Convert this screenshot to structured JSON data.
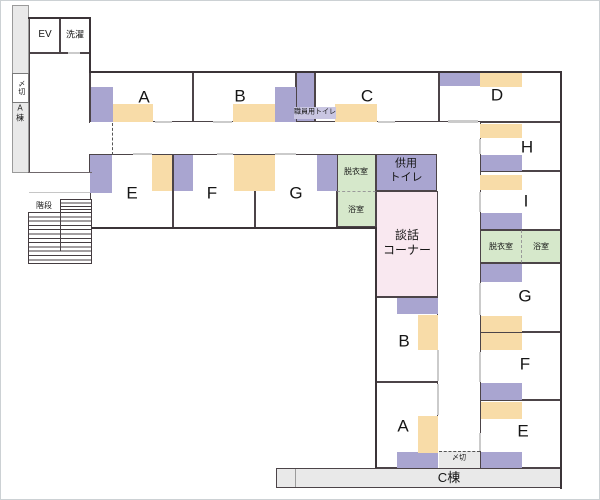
{
  "colors": {
    "white": "#ffffff",
    "gray": "#e9e9e9",
    "purple": "#a9a5d0",
    "orange": "#f8dca8",
    "green": "#d6e8cb",
    "pink": "#f9e8f0",
    "lightPurple": "#c9c6e2",
    "wall": "#3b3438"
  },
  "floorplan": {
    "areas": [
      {
        "n": "a-wing-strip",
        "x": 12,
        "y": 5,
        "w": 17,
        "h": 168,
        "f": "gray",
        "c": "thin"
      },
      {
        "n": "shimekiri-left-box",
        "x": 12,
        "y": 73,
        "w": 17,
        "h": 30,
        "f": "white",
        "c": "thin2"
      },
      {
        "n": "hall",
        "x": 29,
        "y": 53,
        "w": 61,
        "h": 120
      },
      {
        "n": "ev-room",
        "x": 29,
        "y": 18,
        "w": 31,
        "h": 35
      },
      {
        "n": "laundry-room",
        "x": 60,
        "y": 18,
        "w": 30,
        "h": 35
      },
      {
        "n": "room-a",
        "x": 90,
        "y": 72,
        "w": 103,
        "h": 50
      },
      {
        "n": "room-b",
        "x": 193,
        "y": 72,
        "w": 103,
        "h": 50
      },
      {
        "n": "staff-toilet-room",
        "x": 296,
        "y": 72,
        "w": 19,
        "h": 50,
        "f": "purple"
      },
      {
        "n": "room-c",
        "x": 315,
        "y": 72,
        "w": 124,
        "h": 50
      },
      {
        "n": "room-d",
        "x": 439,
        "y": 72,
        "w": 123,
        "h": 50
      },
      {
        "n": "room-e",
        "x": 90,
        "y": 154,
        "w": 83,
        "h": 74
      },
      {
        "n": "room-f",
        "x": 173,
        "y": 154,
        "w": 82,
        "h": 74
      },
      {
        "n": "room-g",
        "x": 255,
        "y": 154,
        "w": 82,
        "h": 74
      },
      {
        "n": "dressing-room-top",
        "x": 337,
        "y": 154,
        "w": 39,
        "h": 38,
        "f": "green",
        "c": "dash-b"
      },
      {
        "n": "bath-room-top",
        "x": 337,
        "y": 192,
        "w": 39,
        "h": 35,
        "f": "green",
        "c": "no-t"
      },
      {
        "n": "shared-toilet-room",
        "x": 376,
        "y": 154,
        "w": 61,
        "h": 37,
        "f": "purple"
      },
      {
        "n": "lounge-corner",
        "x": 376,
        "y": 191,
        "w": 62,
        "h": 106,
        "f": "pink"
      },
      {
        "n": "room-b-central",
        "x": 376,
        "y": 297,
        "w": 62,
        "h": 85
      },
      {
        "n": "room-a-central",
        "x": 376,
        "y": 382,
        "w": 62,
        "h": 86
      },
      {
        "n": "room-h",
        "x": 480,
        "y": 122,
        "w": 82,
        "h": 49
      },
      {
        "n": "room-i",
        "x": 480,
        "y": 171,
        "w": 82,
        "h": 59
      },
      {
        "n": "dressing-room-right",
        "x": 480,
        "y": 230,
        "w": 42,
        "h": 33,
        "f": "green",
        "c": "dash-r"
      },
      {
        "n": "bath-room-right",
        "x": 522,
        "y": 230,
        "w": 40,
        "h": 33,
        "f": "green",
        "c": "no-l"
      },
      {
        "n": "room-g-right",
        "x": 480,
        "y": 263,
        "w": 82,
        "h": 69
      },
      {
        "n": "room-f-right",
        "x": 480,
        "y": 332,
        "w": 82,
        "h": 68
      },
      {
        "n": "room-e-right",
        "x": 480,
        "y": 400,
        "w": 82,
        "h": 68
      },
      {
        "n": "c-wing-corridor",
        "x": 276,
        "y": 468,
        "w": 286,
        "h": 20,
        "f": "gray"
      },
      {
        "n": "shimekiri-bottom-box",
        "x": 439,
        "y": 451,
        "w": 41,
        "h": 17,
        "f": "gray",
        "c": "dash-t-only"
      },
      {
        "n": "stairs-upper-flight",
        "x": 60,
        "y": 199,
        "w": 32,
        "h": 14,
        "c": "steps-u"
      },
      {
        "n": "stairs-main-flight",
        "x": 28,
        "y": 212,
        "w": 64,
        "h": 52,
        "c": "steps-m"
      }
    ],
    "furniture": [
      {
        "n": "furniture-a-purple",
        "x": 91,
        "y": 87,
        "w": 22,
        "h": 35,
        "f": "purple"
      },
      {
        "n": "furniture-b-purple",
        "x": 275,
        "y": 87,
        "w": 21,
        "h": 35,
        "f": "purple"
      },
      {
        "n": "furniture-d-purple",
        "x": 440,
        "y": 73,
        "w": 40,
        "h": 13,
        "f": "purple"
      },
      {
        "n": "furniture-e-purple",
        "x": 90,
        "y": 155,
        "w": 22,
        "h": 38,
        "f": "purple"
      },
      {
        "n": "furniture-f-purple",
        "x": 174,
        "y": 155,
        "w": 19,
        "h": 36,
        "f": "purple"
      },
      {
        "n": "furniture-g-purple",
        "x": 317,
        "y": 155,
        "w": 20,
        "h": 36,
        "f": "purple"
      },
      {
        "n": "furniture-b-central-purple",
        "x": 397,
        "y": 298,
        "w": 41,
        "h": 16,
        "f": "purple"
      },
      {
        "n": "furniture-a-central-purple",
        "x": 397,
        "y": 452,
        "w": 41,
        "h": 16,
        "f": "purple"
      },
      {
        "n": "furniture-h-purple",
        "x": 481,
        "y": 155,
        "w": 41,
        "h": 16,
        "f": "purple"
      },
      {
        "n": "furniture-i-purple",
        "x": 481,
        "y": 213,
        "w": 41,
        "h": 16,
        "f": "purple"
      },
      {
        "n": "furniture-g-right-purple",
        "x": 481,
        "y": 264,
        "w": 41,
        "h": 18,
        "f": "purple"
      },
      {
        "n": "furniture-f-right-purple",
        "x": 481,
        "y": 383,
        "w": 41,
        "h": 17,
        "f": "purple"
      },
      {
        "n": "furniture-e-right-purple",
        "x": 481,
        "y": 452,
        "w": 41,
        "h": 16,
        "f": "purple"
      },
      {
        "n": "furniture-a-orange",
        "x": 113,
        "y": 104,
        "w": 40,
        "h": 18,
        "f": "orange"
      },
      {
        "n": "furniture-b-orange",
        "x": 233,
        "y": 104,
        "w": 42,
        "h": 18,
        "f": "orange"
      },
      {
        "n": "furniture-c-orange",
        "x": 335,
        "y": 104,
        "w": 42,
        "h": 18,
        "f": "orange"
      },
      {
        "n": "furniture-d-orange",
        "x": 480,
        "y": 72,
        "w": 42,
        "h": 15,
        "f": "orange"
      },
      {
        "n": "furniture-e-orange",
        "x": 152,
        "y": 155,
        "w": 20,
        "h": 36,
        "f": "orange"
      },
      {
        "n": "furniture-f-orange",
        "x": 234,
        "y": 155,
        "w": 21,
        "h": 36,
        "f": "orange"
      },
      {
        "n": "furniture-g-orange",
        "x": 255,
        "y": 155,
        "w": 20,
        "h": 36,
        "f": "orange"
      },
      {
        "n": "furniture-b-central-orange",
        "x": 418,
        "y": 315,
        "w": 20,
        "h": 35,
        "f": "orange"
      },
      {
        "n": "furniture-a-central-orange",
        "x": 418,
        "y": 416,
        "w": 20,
        "h": 37,
        "f": "orange"
      },
      {
        "n": "furniture-h-orange",
        "x": 480,
        "y": 124,
        "w": 42,
        "h": 14,
        "f": "orange"
      },
      {
        "n": "furniture-i-orange",
        "x": 480,
        "y": 175,
        "w": 42,
        "h": 15,
        "f": "orange"
      },
      {
        "n": "furniture-g-right-orange",
        "x": 481,
        "y": 316,
        "w": 41,
        "h": 16,
        "f": "orange"
      },
      {
        "n": "furniture-f-right-orange",
        "x": 481,
        "y": 333,
        "w": 41,
        "h": 17,
        "f": "orange"
      },
      {
        "n": "furniture-e-right-orange",
        "x": 481,
        "y": 402,
        "w": 41,
        "h": 17,
        "f": "orange"
      },
      {
        "n": "staff-toilet-label-bg",
        "x": 294,
        "y": 107,
        "w": 42,
        "h": 12,
        "f": "lightPurple"
      }
    ],
    "walls": [
      {
        "n": "wall-ev-top",
        "x": 28,
        "y": 17,
        "w": 63,
        "h": 2
      },
      {
        "n": "wall-ev-right",
        "x": 89,
        "y": 17,
        "w": 2,
        "h": 56
      },
      {
        "n": "wall-top",
        "x": 90,
        "y": 71,
        "w": 472,
        "h": 2
      },
      {
        "n": "wall-right",
        "x": 560,
        "y": 71,
        "w": 2,
        "h": 418
      },
      {
        "n": "wall-row2-bottom",
        "x": 91,
        "y": 227,
        "w": 286,
        "h": 2
      },
      {
        "n": "wall-central-left",
        "x": 375,
        "y": 227,
        "w": 2,
        "h": 241
      },
      {
        "n": "wall-hall-bottom",
        "x": 28,
        "y": 172,
        "w": 64,
        "h": 1,
        "f": "#6f676b"
      },
      {
        "n": "stairs-divider",
        "x": 60,
        "y": 212,
        "w": 1,
        "h": 39,
        "f": "#4a4246"
      },
      {
        "n": "c-strip-divider",
        "x": 295,
        "y": 469,
        "w": 1,
        "h": 18,
        "f": "#9b9b9b"
      }
    ],
    "gaps": [
      {
        "n": "door-room-a",
        "x": 155,
        "y": 121,
        "w": 17,
        "h": 2
      },
      {
        "n": "door-room-b",
        "x": 213,
        "y": 121,
        "w": 19,
        "h": 2
      },
      {
        "n": "door-room-c",
        "x": 378,
        "y": 121,
        "w": 17,
        "h": 2
      },
      {
        "n": "opening-corridor-d",
        "x": 448,
        "y": 120,
        "w": 30,
        "h": 3
      },
      {
        "n": "door-room-e",
        "x": 133,
        "y": 153,
        "w": 19,
        "h": 2
      },
      {
        "n": "door-room-f",
        "x": 217,
        "y": 153,
        "w": 16,
        "h": 2
      },
      {
        "n": "door-room-g",
        "x": 275,
        "y": 153,
        "w": 21,
        "h": 2
      },
      {
        "n": "door-laundry",
        "x": 68,
        "y": 52,
        "w": 12,
        "h": 2
      },
      {
        "n": "door-room-h",
        "x": 479,
        "y": 139,
        "w": 2,
        "h": 15
      },
      {
        "n": "door-room-i",
        "x": 479,
        "y": 192,
        "w": 2,
        "h": 20
      },
      {
        "n": "door-room-g-right",
        "x": 479,
        "y": 283,
        "w": 2,
        "h": 32
      },
      {
        "n": "door-room-f-right",
        "x": 479,
        "y": 352,
        "w": 2,
        "h": 30
      },
      {
        "n": "door-room-e-right",
        "x": 479,
        "y": 433,
        "w": 2,
        "h": 18
      },
      {
        "n": "door-room-b-central",
        "x": 437,
        "y": 350,
        "w": 2,
        "h": 31
      },
      {
        "n": "door-room-a-central",
        "x": 437,
        "y": 384,
        "w": 2,
        "h": 31
      },
      {
        "n": "opening-hall-corridor",
        "x": 88,
        "y": 123,
        "w": 3,
        "h": 31,
        "f": "#ffffff"
      },
      {
        "n": "stair-landing-line",
        "x": 29,
        "y": 192,
        "w": 61,
        "h": 1,
        "f": "#c6c6c6"
      },
      {
        "n": "corridor-dashed-line",
        "x": 112,
        "y": 123,
        "w": 1,
        "h": 32,
        "c": "dashv"
      }
    ],
    "labels": [
      {
        "n": "label-ev",
        "t": "EV",
        "x": 45,
        "y": 35,
        "s": 10
      },
      {
        "n": "label-laundry",
        "t": "洗濯",
        "x": 75,
        "y": 35,
        "s": 9
      },
      {
        "n": "label-shimekiri-left",
        "t": "〆切",
        "x": 20.5,
        "y": 88,
        "s": 7,
        "c": "vert"
      },
      {
        "n": "label-a-wing",
        "t": "A棟",
        "x": 19.5,
        "y": 113,
        "s": 8,
        "c": "vert"
      },
      {
        "n": "label-room-a",
        "t": "A",
        "x": 144,
        "y": 97,
        "s": 17
      },
      {
        "n": "label-room-b",
        "t": "B",
        "x": 240,
        "y": 96,
        "s": 17
      },
      {
        "n": "label-room-c",
        "t": "C",
        "x": 367,
        "y": 96,
        "s": 17
      },
      {
        "n": "label-room-d",
        "t": "D",
        "x": 497,
        "y": 95,
        "s": 17
      },
      {
        "n": "label-staff-toilet",
        "t": "職員用トイレ",
        "x": 315,
        "y": 113,
        "s": 7
      },
      {
        "n": "label-room-e",
        "t": "E",
        "x": 132,
        "y": 193,
        "s": 17
      },
      {
        "n": "label-room-f",
        "t": "F",
        "x": 212,
        "y": 193,
        "s": 17
      },
      {
        "n": "label-room-g",
        "t": "G",
        "x": 296,
        "y": 193,
        "s": 17
      },
      {
        "n": "label-dressing-top",
        "t": "脱衣室",
        "x": 356,
        "y": 172,
        "s": 8
      },
      {
        "n": "label-bath-top",
        "t": "浴室",
        "x": 356,
        "y": 210,
        "s": 8
      },
      {
        "n": "label-shared-toilet",
        "t": "供用\nトイレ",
        "x": 406,
        "y": 171,
        "s": 11
      },
      {
        "n": "label-lounge",
        "t": "談話\nコーナー",
        "x": 407,
        "y": 243,
        "s": 12
      },
      {
        "n": "label-room-h",
        "t": "H",
        "x": 527,
        "y": 147,
        "s": 17
      },
      {
        "n": "label-room-i",
        "t": "I",
        "x": 526,
        "y": 201,
        "s": 17
      },
      {
        "n": "label-dressing-right",
        "t": "脱衣室",
        "x": 501,
        "y": 247,
        "s": 8
      },
      {
        "n": "label-bath-right",
        "t": "浴室",
        "x": 541,
        "y": 247,
        "s": 8
      },
      {
        "n": "label-room-g-right",
        "t": "G",
        "x": 525,
        "y": 296,
        "s": 17
      },
      {
        "n": "label-room-f-right",
        "t": "F",
        "x": 525,
        "y": 364,
        "s": 17
      },
      {
        "n": "label-room-e-right",
        "t": "E",
        "x": 523,
        "y": 431,
        "s": 17
      },
      {
        "n": "label-room-b-central",
        "t": "B",
        "x": 404,
        "y": 341,
        "s": 17
      },
      {
        "n": "label-room-a-central",
        "t": "A",
        "x": 403,
        "y": 426,
        "s": 17
      },
      {
        "n": "label-stairs",
        "t": "階段",
        "x": 44,
        "y": 206,
        "s": 8
      },
      {
        "n": "label-shimekiri-bottom",
        "t": "〆切",
        "x": 459,
        "y": 459,
        "s": 7
      },
      {
        "n": "label-c-wing",
        "t": "C棟",
        "x": 449,
        "y": 478,
        "s": 13
      }
    ]
  }
}
